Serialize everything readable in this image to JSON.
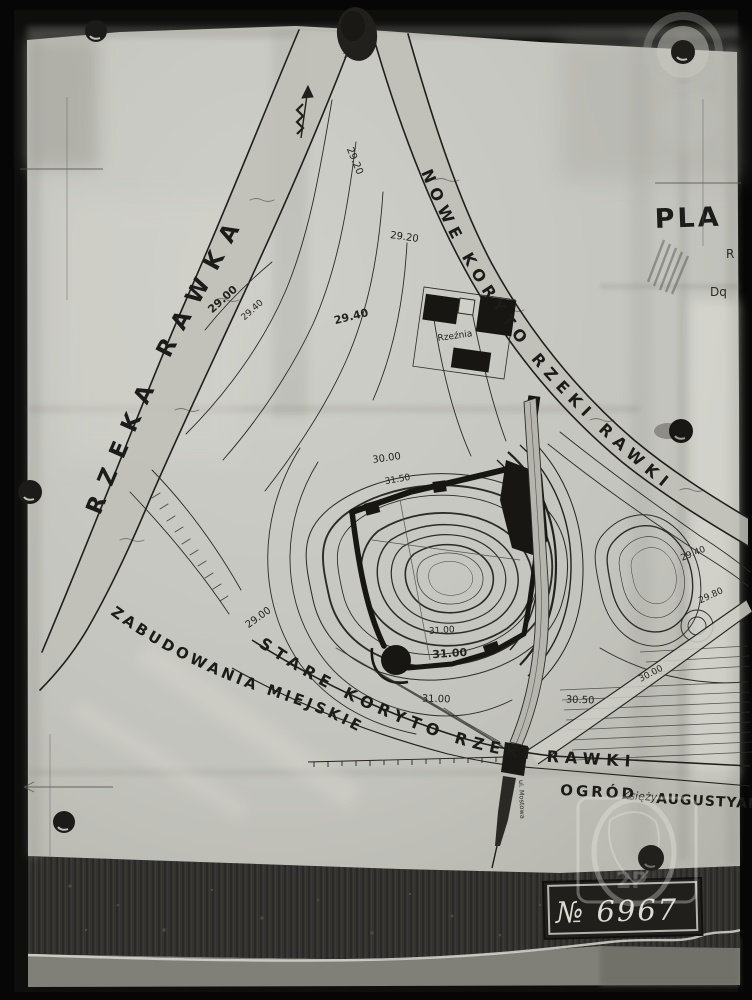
{
  "photo": {
    "plate_number": "№ 6967",
    "seal_text": "2P"
  },
  "map": {
    "labels": {
      "river": "RZEKA RAWKA",
      "new_channel": "NOWE KORYTO RZEKI RAWKI",
      "old_channel": "STARE KORYTO RZEKI RAWKI",
      "town": "ZABUDOWANIA MIEJSKIE",
      "garden_1": "OGRÓD",
      "garden_2": "Księży",
      "garden_3": "AUGUSTYANÓW",
      "slaughterhouse": "Rzeźnia",
      "street": "ul. Mostowa",
      "title_fragment": "PLA",
      "margin_fragment_1": "R",
      "margin_fragment_2": "Dq",
      "water_level": "26.25"
    },
    "contour_labels": [
      "29.20",
      "29.20",
      "29.00",
      "29.40",
      "29.40",
      "30.00",
      "31.50",
      "31.00",
      "31.00",
      "31.00",
      "30.50",
      "29.40",
      "29.80",
      "30.00",
      "29.00"
    ]
  }
}
